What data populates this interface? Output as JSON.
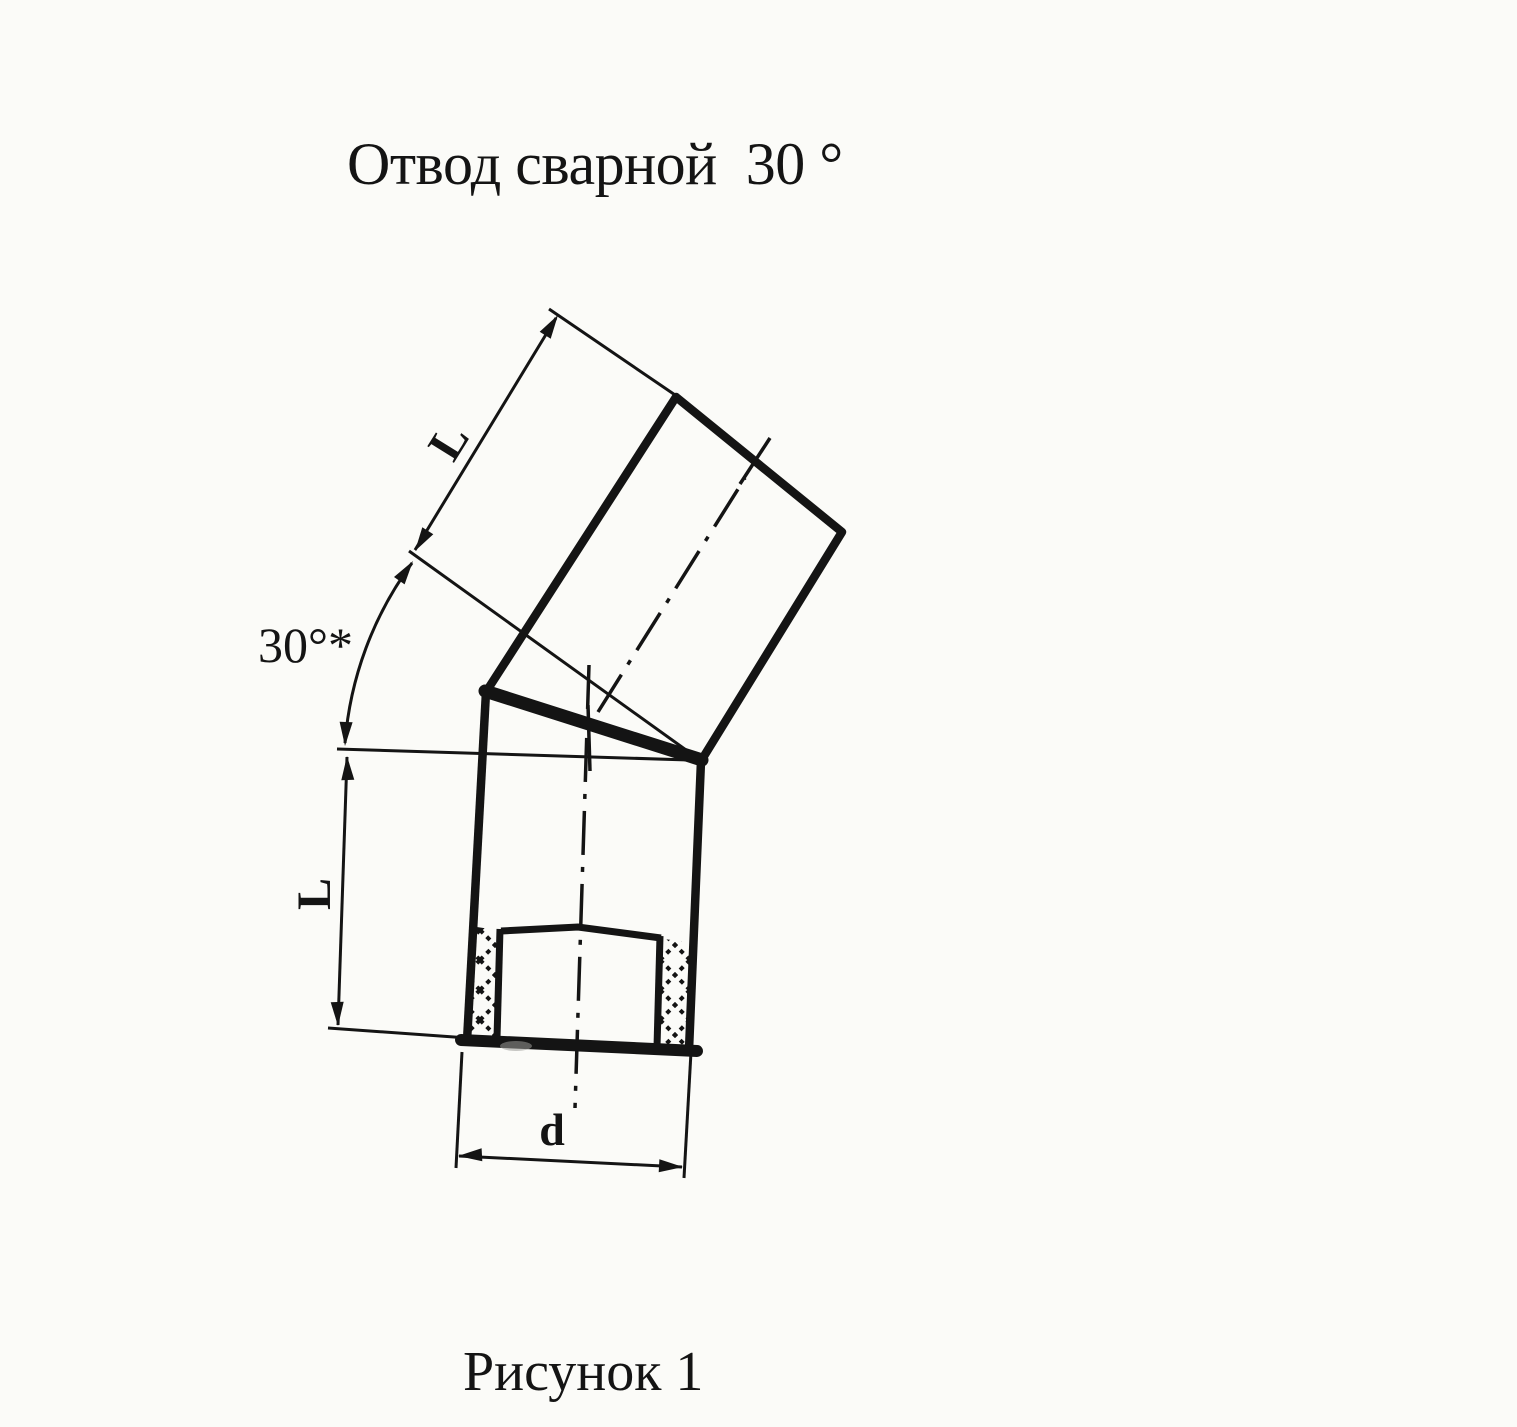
{
  "page": {
    "title": "Отвод сварной  30 °",
    "caption": "Рисунок 1"
  },
  "drawing": {
    "kind": "welded-pipe-elbow-30deg-section-view",
    "labels": {
      "segment_length_upper": "L",
      "segment_length_lower": "L",
      "angle": "30°*",
      "diameter": "d"
    }
  },
  "colors": {
    "ink": "#141414",
    "paper": "#fbfbf8"
  }
}
